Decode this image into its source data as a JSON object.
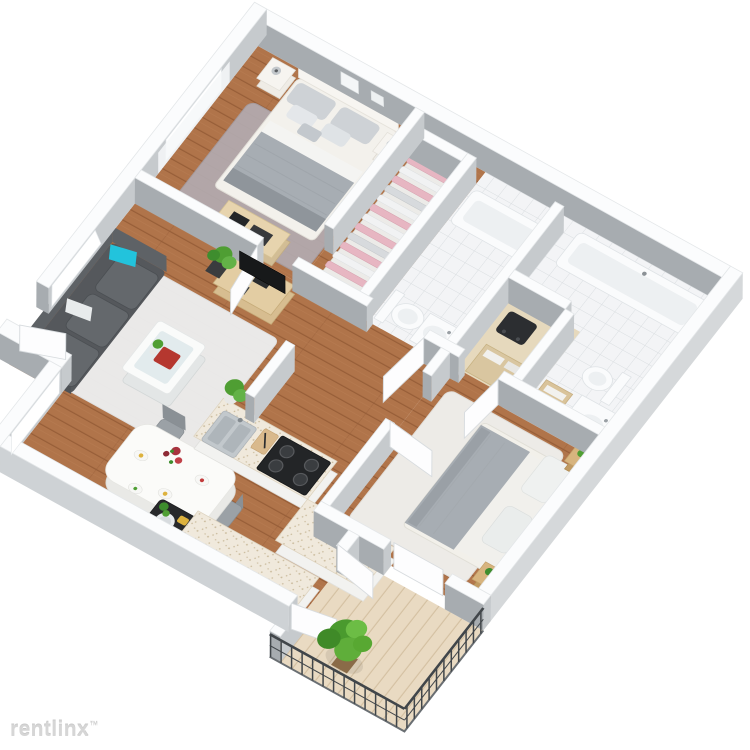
{
  "watermark": {
    "brand": "rentlinx",
    "mark": "™"
  },
  "scene": {
    "type": "3d-isometric-floor-plan",
    "description": "Two-bedroom apartment 3D floor plan viewed from above at an angle",
    "rooms": [
      {
        "name": "master-bedroom",
        "furniture": [
          "double-bed-gray-white",
          "nightstand-left-with-lamp",
          "nightstand-right-with-lamp",
          "gray-shag-rug",
          "desk-with-black-electronics",
          "window",
          "wall-art"
        ]
      },
      {
        "name": "walk-in-closet",
        "furniture": [
          "row-of-hanging-clothes-pink-and-white"
        ]
      },
      {
        "name": "bathroom-one",
        "furniture": [
          "bathtub",
          "toilet",
          "pedestal-sink",
          "white-tile-floor"
        ]
      },
      {
        "name": "laundry-closet",
        "furniture": [
          "shelving-with-towels",
          "dark-appliance"
        ]
      },
      {
        "name": "bathroom-two",
        "furniture": [
          "bathtub",
          "toilet",
          "vanity-sink",
          "wooden-bench-with-towels",
          "white-tile-floor"
        ]
      },
      {
        "name": "living-room",
        "furniture": [
          "dark-gray-sofa",
          "teal-accent-pillow",
          "white-area-rug",
          "coffee-table-with-red-book-and-plant",
          "tv-stand",
          "flat-screen-tv",
          "potted-plant",
          "window",
          "white-curtain"
        ]
      },
      {
        "name": "dining-area",
        "furniture": [
          "white-dining-table",
          "four-gray-chairs",
          "place-settings",
          "red-flower-centerpiece",
          "window",
          "dark-pet-tray-with-bowl"
        ]
      },
      {
        "name": "kitchen",
        "furniture": [
          "l-shaped-counter-speckled-top",
          "double-stainless-sink",
          "black-four-burner-stove",
          "cutting-board-with-knife",
          "counter-plant",
          "sideboard-counter"
        ]
      },
      {
        "name": "second-bedroom",
        "furniture": [
          "double-bed-gray-white",
          "two-wood-nightstands-with-plants",
          "white-area-rug",
          "sliding-balcony-door"
        ]
      },
      {
        "name": "balcony",
        "furniture": [
          "wood-deck",
          "metal-railing",
          "large-green-potted-plant",
          "french-doors"
        ]
      },
      {
        "name": "hallway",
        "furniture": [
          "open-interior-doors"
        ]
      }
    ]
  },
  "palette": {
    "wall_cap": "#fbfcfd",
    "wall_edge": "#e4e7e9",
    "face_dark": "#a7acb0",
    "face_light": "#c6cacd",
    "face_outer_right": "#d5d8da",
    "face_outer_bottom": "#ced2d5",
    "wood": "#b0744a",
    "wood_line": "#975e38",
    "tile": "#f3f4f6",
    "tile_line": "#d9dde0",
    "deck": "#e9dac2",
    "deck_line": "#d3bfa0",
    "speckle_bg": "#f0e9dc",
    "speckle_dot": "#cbbc9e",
    "rug_gray": "#b3abb0",
    "rug_white": "#eef0f1",
    "sofa": "#55585c",
    "sofa_light": "#64686c",
    "teal": "#22c3dc",
    "duvet": "#a7adb3",
    "clothes_pink": "#e7b6c2",
    "furniture_wood": "#d7bd90",
    "tan": "#dcc7a0",
    "plant_green": "#4f9e33",
    "plant_green_dark": "#3e8d2e",
    "railing": "#41464a",
    "appliance_dark": "#232527",
    "book_red": "#b5372f",
    "accent_yellow": "#ddb23e",
    "watermark": "#d6d6d6"
  }
}
